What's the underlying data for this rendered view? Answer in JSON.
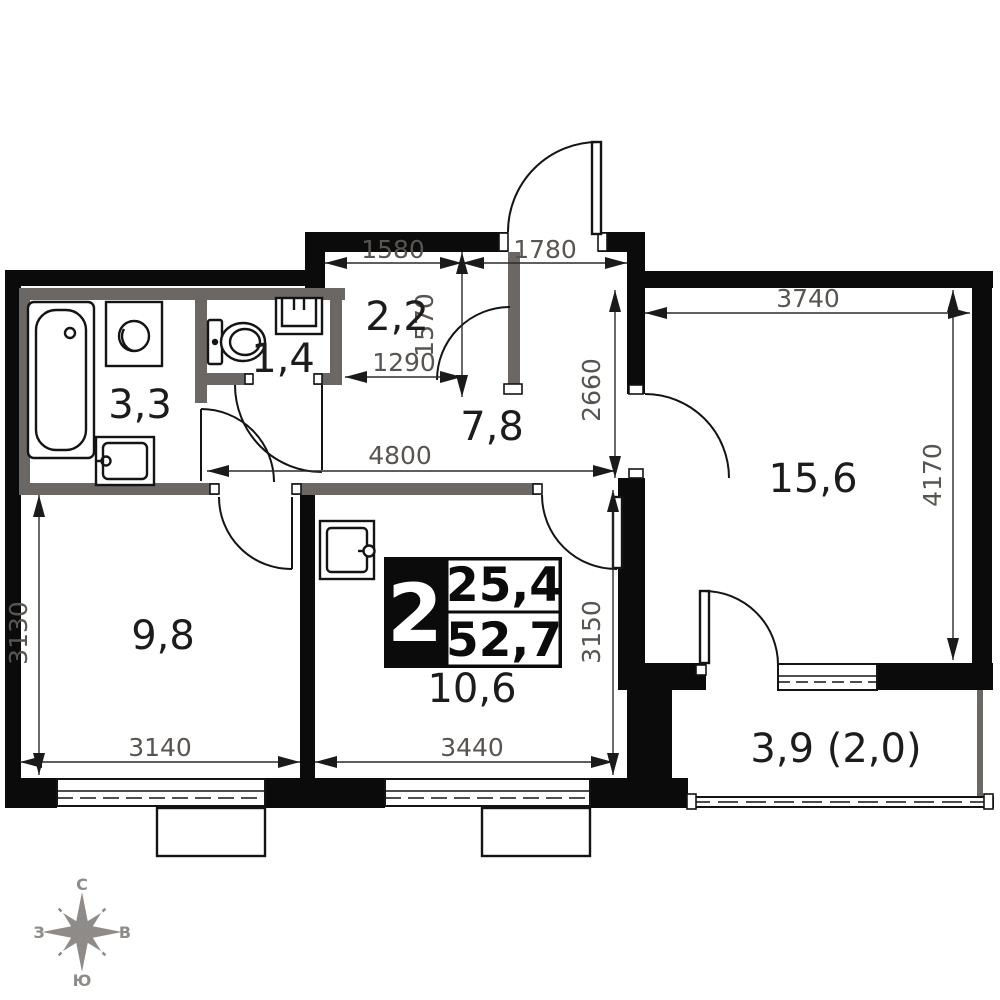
{
  "plan": {
    "title": "2-room apartment floor plan",
    "badge": {
      "rooms": "2",
      "living_area": "25,4",
      "total_area": "52,7"
    },
    "rooms": {
      "closet": "2,2",
      "wc": "1,4",
      "bath": "3,3",
      "hall": "7,8",
      "living": "15,6",
      "bedroom": "9,8",
      "kitchen": "10,6",
      "balcony": "3,9 (2,0)"
    },
    "dims": {
      "d1580": "1580",
      "d1780": "1780",
      "d1570": "1570",
      "d1290": "1290",
      "d2660": "2660",
      "d3740": "3740",
      "d4170": "4170",
      "d4800": "4800",
      "d3150": "3150",
      "d3130": "3130",
      "d3140": "3140",
      "d3440": "3440"
    },
    "compass": {
      "n": "С",
      "s": "Ю",
      "w": "З",
      "e": "В"
    },
    "colors": {
      "wall": "#0b0b0b",
      "partition": "#6b6764",
      "dim_text": "#585450",
      "label_text": "#1c1c1c",
      "compass": "#8e8b88",
      "background": "#ffffff"
    }
  }
}
